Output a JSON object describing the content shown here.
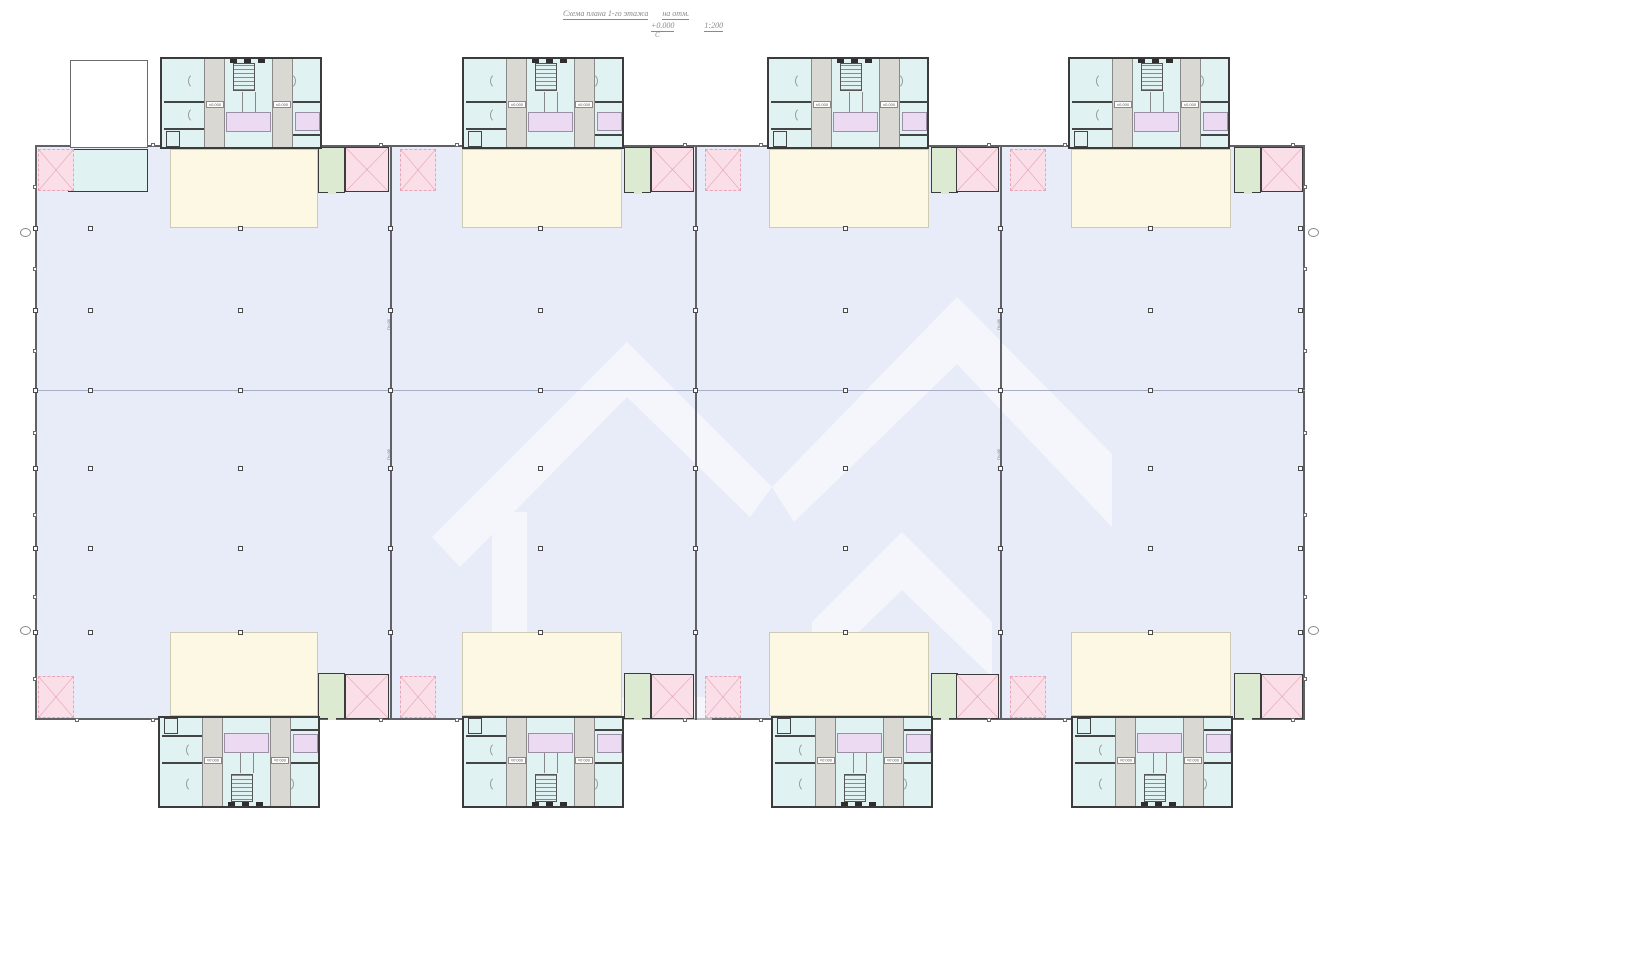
{
  "title": {
    "line1": "Схема плана 1-го этажа",
    "line1b": "на отм.",
    "elevation": "+0.000",
    "scale": "1:200",
    "north_mark": "С"
  },
  "labels": {
    "elevation_tag": "±0.000",
    "wall_tag": "Пч-08"
  },
  "colors": {
    "hall": "#e8ecf8",
    "wall": "#5f6166",
    "cream": "#fdf8e3",
    "cyan": "#e0f3f2",
    "strip": "#d9d8d2",
    "purple": "#ecdaf2",
    "green": "#dcead1",
    "pink": "#fbdfe8",
    "pinkline": "#e4a7b8"
  },
  "layout": {
    "hall": {
      "left": 35,
      "top": 145,
      "width": 1270,
      "height": 575
    },
    "mid_y": 390,
    "wall_xs": [
      390,
      695,
      1000
    ],
    "module_top_xs": [
      160,
      462,
      767,
      1068
    ],
    "module_bottom_xs": [
      158,
      462,
      771,
      1071
    ],
    "module_top_y": 57,
    "module_bottom_y": 716,
    "cream": [
      {
        "x": 170,
        "w": 148
      },
      {
        "x": 462,
        "w": 160
      },
      {
        "x": 769,
        "w": 160
      },
      {
        "x": 1071,
        "w": 160
      }
    ],
    "cream_top_y": 149,
    "cream_top_h": 79,
    "cream_bot_y": 632,
    "cream_bot_h": 84,
    "green_xs": [
      318,
      624,
      931,
      1234
    ],
    "pink_solid": [
      {
        "x": 345,
        "w": 44
      },
      {
        "x": 651,
        "w": 43
      },
      {
        "x": 956,
        "w": 43
      },
      {
        "x": 1261,
        "w": 42
      }
    ],
    "pink_dashed_xs": [
      38,
      400,
      705,
      1010
    ],
    "col_xs": [
      35,
      90,
      240,
      390,
      540,
      695,
      845,
      1000,
      1150,
      1300
    ],
    "col_ys": [
      228,
      310,
      390,
      468,
      548,
      632
    ],
    "bubbles": [
      [
        20,
        228
      ],
      [
        20,
        626
      ],
      [
        1308,
        228
      ],
      [
        1308,
        626
      ]
    ],
    "wall_tags": [
      [
        386,
        330
      ],
      [
        386,
        460
      ],
      [
        996,
        330
      ],
      [
        996,
        460
      ]
    ]
  }
}
